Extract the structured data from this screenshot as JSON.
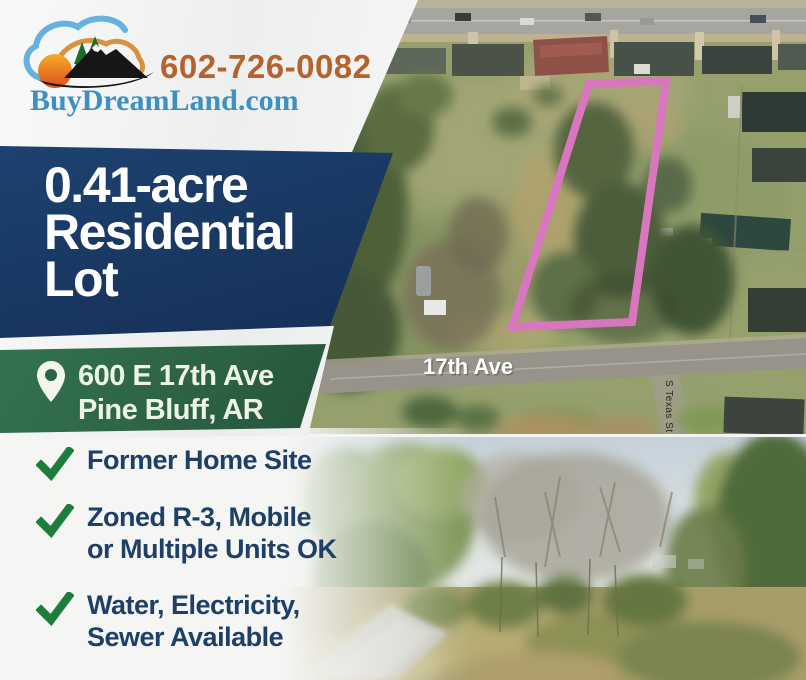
{
  "brand": {
    "phone": "602-726-0082",
    "website": "BuyDreamLand.com"
  },
  "headline": {
    "lines": [
      "0.41-acre",
      "Residential",
      "Lot"
    ]
  },
  "address": {
    "street": "600 E 17th Ave",
    "city_state": "Pine Bluff, AR"
  },
  "features": [
    {
      "line1": "Former Home Site",
      "line2": ""
    },
    {
      "line1": "Zoned R-3, Mobile",
      "line2": "or Multiple Units OK"
    },
    {
      "line1": "Water, Electricity,",
      "line2": "Sewer Available"
    }
  ],
  "aerial_photo": {
    "street_label": "17th Ave",
    "cross_street_label": "S Texas St",
    "lot_outline_color": "#d877c0"
  },
  "colors": {
    "headline_bg": "#1b3e6b",
    "address_bg": "#2c6143",
    "checkmark_green": "#1d7e3b",
    "feature_text_navy": "#1e3f68",
    "phone_orange": "#b5622d",
    "website_blue": "#3e8fc3",
    "lot_outline_pink": "#d877c0"
  }
}
